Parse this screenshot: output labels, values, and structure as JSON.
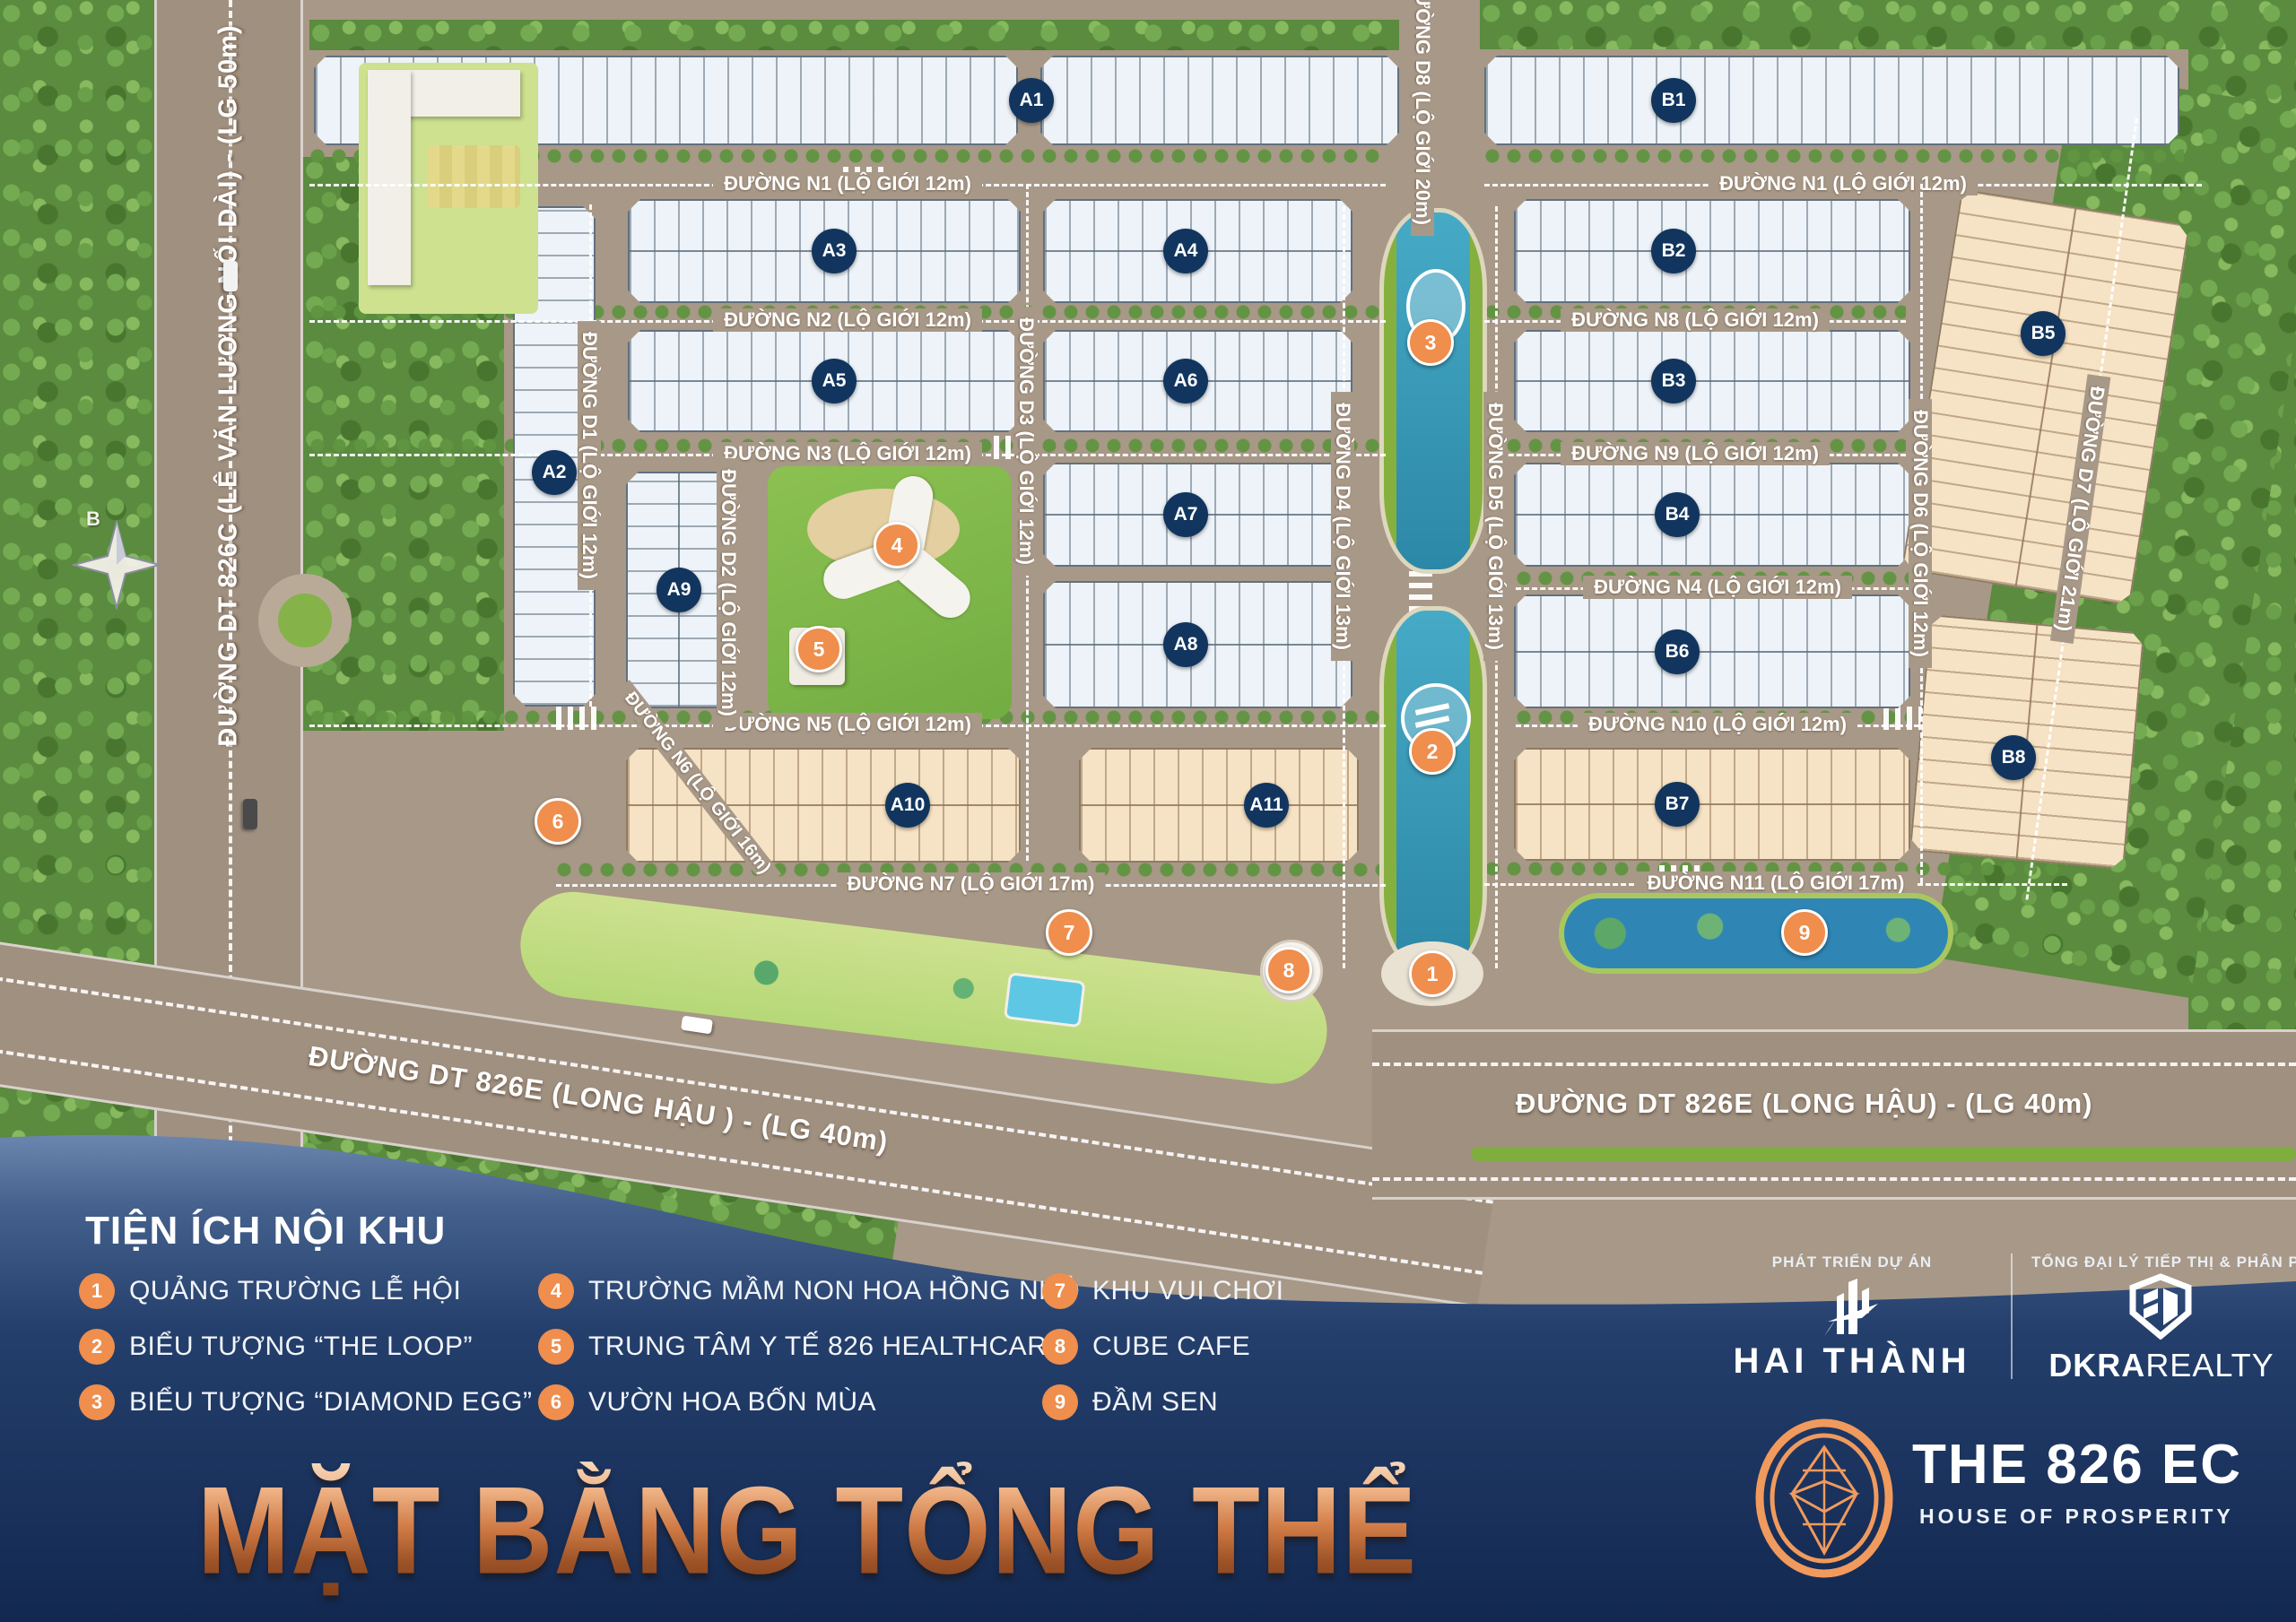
{
  "title": "MẶT BẰNG TỔNG THỂ",
  "legend": {
    "title": "TIỆN ÍCH NỘI KHU",
    "items": [
      {
        "num": "1",
        "label": "QUẢNG TRƯỜNG LỄ HỘI"
      },
      {
        "num": "2",
        "label": "BIỂU TƯỢNG “THE LOOP”"
      },
      {
        "num": "3",
        "label": "BIỂU TƯỢNG “DIAMOND EGG”"
      },
      {
        "num": "4",
        "label": "TRƯỜNG MẦM NON HOA HỒNG NHỎ"
      },
      {
        "num": "5",
        "label": "TRUNG TÂM Y TẾ 826 HEALTHCARE"
      },
      {
        "num": "6",
        "label": "VƯỜN HOA BỐN MÙA"
      },
      {
        "num": "7",
        "label": "KHU VUI CHƠI"
      },
      {
        "num": "8",
        "label": "CUBE CAFE"
      },
      {
        "num": "9",
        "label": "ĐẦM SEN"
      }
    ]
  },
  "branding": {
    "developer_heading": "PHÁT TRIỂN DỰ ÁN",
    "developer_name": "HAI THÀNH",
    "distributor_heading": "TỔNG ĐẠI LÝ TIẾP THỊ & PHÂN PHỐI",
    "distributor_name_bold": "DKRA",
    "distributor_name_light": "REALTY",
    "project_name": "THE 826 EC",
    "project_tagline": "HOUSE OF PROSPERITY"
  },
  "compass": {
    "north_label": "B"
  },
  "map": {
    "major_roads": [
      {
        "id": "dt826c",
        "label": "ĐƯỜNG DT 826C (LÊ VĂN LƯƠNG NỐI DÀI) - (LG 50m)"
      },
      {
        "id": "dt826e-left",
        "label": "ĐƯỜNG DT 826E (LONG HẬU ) - (LG 40m)"
      },
      {
        "id": "dt826e-right",
        "label": "ĐƯỜNG DT 826E (LONG HẬU) - (LG 40m)"
      }
    ],
    "streets": [
      {
        "id": "n1-left",
        "label": "ĐƯỜNG N1 (LỘ GIỚI 12m)"
      },
      {
        "id": "n2",
        "label": "ĐƯỜNG N2 (LỘ GIỚI 12m)"
      },
      {
        "id": "n3",
        "label": "ĐƯỜNG N3 (LỘ GIỚI 12m)"
      },
      {
        "id": "n5",
        "label": "ĐƯỜNG N5 (LỘ GIỚI 12m)"
      },
      {
        "id": "n7",
        "label": "ĐƯỜNG N7 (LỘ GIỚI 17m)"
      },
      {
        "id": "n1-right",
        "label": "ĐƯỜNG N1 (LỘ GIỚI 12m)"
      },
      {
        "id": "n8",
        "label": "ĐƯỜNG N8 (LỘ GIỚI 12m)"
      },
      {
        "id": "n9",
        "label": "ĐƯỜNG N9 (LỘ GIỚI 12m)"
      },
      {
        "id": "n4",
        "label": "ĐƯỜNG N4 (LỘ GIỚI 12m)"
      },
      {
        "id": "n10",
        "label": "ĐƯỜNG N10 (LỘ GIỚI 12m)"
      },
      {
        "id": "n11",
        "label": "ĐƯỜNG N11 (LỘ GIỚI 17m)"
      },
      {
        "id": "n6",
        "label": "ĐƯỜNG N6 (LỘ GIỚI 16m)"
      },
      {
        "id": "d1",
        "label": "ĐƯỜNG D1 (LỘ GIỚI 12m)"
      },
      {
        "id": "d2",
        "label": "ĐƯỜNG D2 (LỘ GIỚI 12m)"
      },
      {
        "id": "d3",
        "label": "ĐƯỜNG D3 (LỘ GIỚI 12m)"
      },
      {
        "id": "d4",
        "label": "ĐƯỜNG D4 (LỘ GIỚI 13m)"
      },
      {
        "id": "d5",
        "label": "ĐƯỜNG D5 (LỘ GIỚI 13m)"
      },
      {
        "id": "d6",
        "label": "ĐƯỜNG D6 (LỘ GIỚI 12m)"
      },
      {
        "id": "d7",
        "label": "ĐƯỜNG D7 (LỘ GIỚI 21m)"
      },
      {
        "id": "d8",
        "label": "ĐƯỜNG D8 (LỘ GIỚI 20m)"
      }
    ],
    "blocks": [
      {
        "id": "A1"
      },
      {
        "id": "A2"
      },
      {
        "id": "A3"
      },
      {
        "id": "A4"
      },
      {
        "id": "A5"
      },
      {
        "id": "A6"
      },
      {
        "id": "A7"
      },
      {
        "id": "A8"
      },
      {
        "id": "A9"
      },
      {
        "id": "A10"
      },
      {
        "id": "A11"
      },
      {
        "id": "B1"
      },
      {
        "id": "B2"
      },
      {
        "id": "B3"
      },
      {
        "id": "B4"
      },
      {
        "id": "B5"
      },
      {
        "id": "B6"
      },
      {
        "id": "B7"
      },
      {
        "id": "B8"
      }
    ],
    "markers": [
      {
        "num": "1"
      },
      {
        "num": "2"
      },
      {
        "num": "3"
      },
      {
        "num": "4"
      },
      {
        "num": "5"
      },
      {
        "num": "6"
      },
      {
        "num": "7"
      },
      {
        "num": "8"
      },
      {
        "num": "9"
      }
    ]
  }
}
